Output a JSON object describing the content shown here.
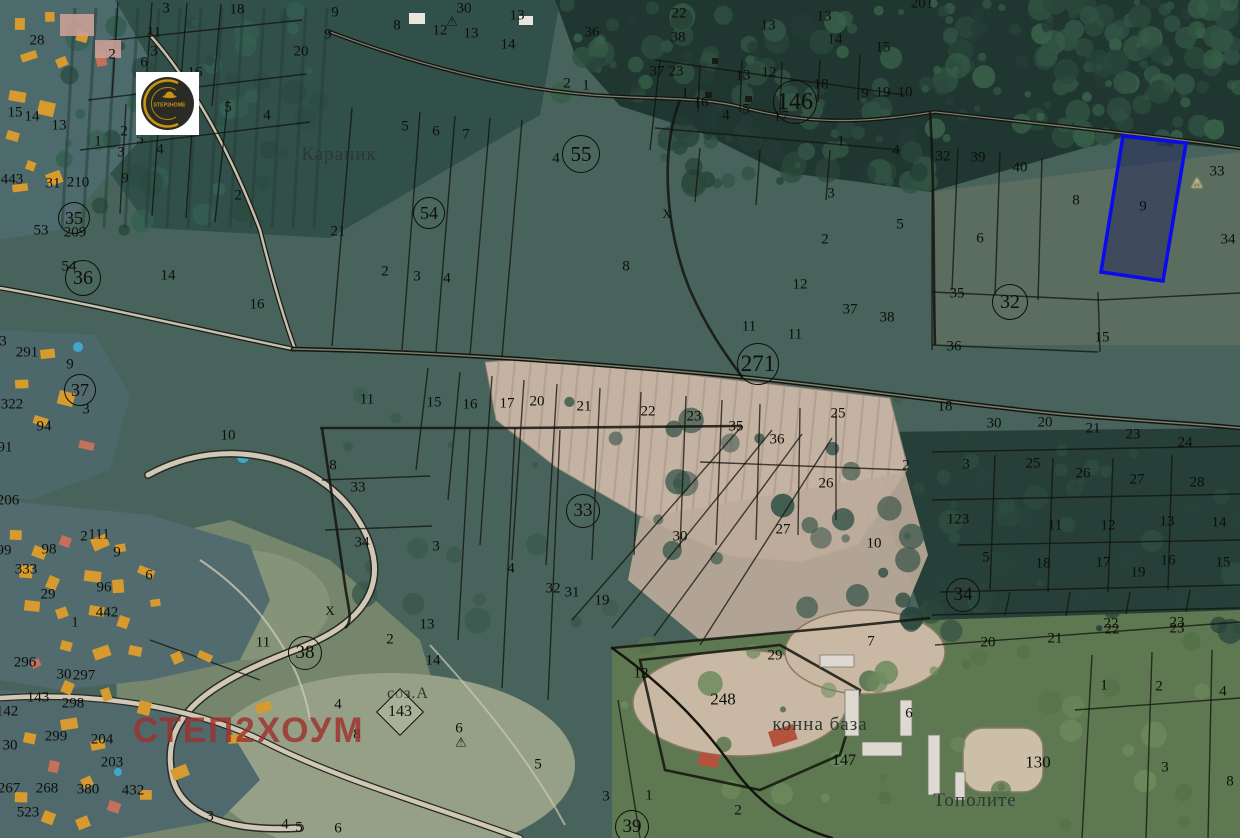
{
  "map": {
    "title": "cadastral-satellite-map",
    "watermark_text": "СТЕП2ХОУМ",
    "logo": {
      "text": "STEP2HOME"
    },
    "colors": {
      "highlight": "#0a0af0",
      "watermark": "#9e312d",
      "logo_gold": "#c8940e"
    },
    "highlighted_parcel": {
      "number": "9",
      "points": "1123,136 1186,143 1163,281 1101,272"
    },
    "place_labels": [
      {
        "t": "Караник",
        "x": 339,
        "y": 155,
        "s": 19
      },
      {
        "t": "соз.А",
        "x": 408,
        "y": 694,
        "s": 16
      },
      {
        "t": "конна база",
        "x": 820,
        "y": 725,
        "s": 19
      },
      {
        "t": "Тополите",
        "x": 975,
        "y": 801,
        "s": 19
      }
    ],
    "zone_markers": [
      {
        "n": "55",
        "x": 581,
        "y": 154,
        "r": 18
      },
      {
        "n": "54",
        "x": 429,
        "y": 213,
        "r": 15
      },
      {
        "n": "146",
        "x": 795,
        "y": 102,
        "r": 21
      },
      {
        "n": "271",
        "x": 758,
        "y": 364,
        "r": 20
      },
      {
        "n": "32",
        "x": 1010,
        "y": 302,
        "r": 17
      },
      {
        "n": "33",
        "x": 583,
        "y": 511,
        "r": 16
      },
      {
        "n": "34",
        "x": 963,
        "y": 595,
        "r": 16
      },
      {
        "n": "35",
        "x": 74,
        "y": 218,
        "r": 15
      },
      {
        "n": "36",
        "x": 83,
        "y": 278,
        "r": 17
      },
      {
        "n": "37",
        "x": 80,
        "y": 390,
        "r": 15
      },
      {
        "n": "38",
        "x": 305,
        "y": 653,
        "r": 16
      },
      {
        "n": "39",
        "x": 632,
        "y": 827,
        "r": 16
      }
    ],
    "diamond_marker": {
      "n": "143",
      "x": 400,
      "y": 712
    },
    "warning_markers": [
      {
        "x": 452,
        "y": 21,
        "variant": "dark"
      },
      {
        "x": 461,
        "y": 742,
        "variant": "dark"
      },
      {
        "x": 1197,
        "y": 183,
        "variant": "gold"
      }
    ],
    "x_marks": [
      {
        "x": 667,
        "y": 214
      },
      {
        "x": 330,
        "y": 611
      }
    ],
    "parcel_labels": [
      {
        "t": "3",
        "x": 166,
        "y": 9
      },
      {
        "t": "18",
        "x": 237,
        "y": 10
      },
      {
        "t": "20",
        "x": 301,
        "y": 52
      },
      {
        "t": "11",
        "x": 154,
        "y": 33
      },
      {
        "t": "3",
        "x": 154,
        "y": 52
      },
      {
        "t": "6",
        "x": 144,
        "y": 63
      },
      {
        "t": "16",
        "x": 195,
        "y": 73
      },
      {
        "t": "2",
        "x": 112,
        "y": 55
      },
      {
        "t": "5",
        "x": 228,
        "y": 108
      },
      {
        "t": "4",
        "x": 267,
        "y": 116
      },
      {
        "t": "28",
        "x": 37,
        "y": 41
      },
      {
        "t": "15",
        "x": 15,
        "y": 113
      },
      {
        "t": "14",
        "x": 32,
        "y": 117
      },
      {
        "t": "13",
        "x": 59,
        "y": 126
      },
      {
        "t": "1",
        "x": 98,
        "y": 142
      },
      {
        "t": "2",
        "x": 124,
        "y": 132
      },
      {
        "t": "5",
        "x": 140,
        "y": 140
      },
      {
        "t": "3",
        "x": 121,
        "y": 153
      },
      {
        "t": "4",
        "x": 160,
        "y": 150
      },
      {
        "t": "9",
        "x": 125,
        "y": 179
      },
      {
        "t": "443",
        "x": 12,
        "y": 180
      },
      {
        "t": "31",
        "x": 53,
        "y": 184
      },
      {
        "t": "210",
        "x": 78,
        "y": 183
      },
      {
        "t": "2",
        "x": 238,
        "y": 196
      },
      {
        "t": "9",
        "x": 335,
        "y": 13
      },
      {
        "t": "9",
        "x": 328,
        "y": 35
      },
      {
        "t": "8",
        "x": 397,
        "y": 26
      },
      {
        "t": "12",
        "x": 440,
        "y": 31
      },
      {
        "t": "13",
        "x": 471,
        "y": 34
      },
      {
        "t": "30",
        "x": 464,
        "y": 9
      },
      {
        "t": "13",
        "x": 517,
        "y": 16
      },
      {
        "t": "14",
        "x": 508,
        "y": 45
      },
      {
        "t": "36",
        "x": 592,
        "y": 33
      },
      {
        "t": "2",
        "x": 567,
        "y": 84
      },
      {
        "t": "1",
        "x": 586,
        "y": 86
      },
      {
        "t": "5",
        "x": 405,
        "y": 127
      },
      {
        "t": "6",
        "x": 436,
        "y": 132
      },
      {
        "t": "7",
        "x": 466,
        "y": 135
      },
      {
        "t": "4",
        "x": 556,
        "y": 159
      },
      {
        "t": "21",
        "x": 338,
        "y": 232
      },
      {
        "t": "2",
        "x": 385,
        "y": 272
      },
      {
        "t": "3",
        "x": 417,
        "y": 277
      },
      {
        "t": "4",
        "x": 447,
        "y": 279
      },
      {
        "t": "22",
        "x": 679,
        "y": 14
      },
      {
        "t": "38",
        "x": 678,
        "y": 38
      },
      {
        "t": "37",
        "x": 657,
        "y": 72
      },
      {
        "t": "23",
        "x": 676,
        "y": 72
      },
      {
        "t": "13",
        "x": 768,
        "y": 26
      },
      {
        "t": "13",
        "x": 824,
        "y": 17
      },
      {
        "t": "14",
        "x": 835,
        "y": 40
      },
      {
        "t": "15",
        "x": 883,
        "y": 48
      },
      {
        "t": "201",
        "x": 922,
        "y": 4
      },
      {
        "t": "12",
        "x": 769,
        "y": 73
      },
      {
        "t": "13",
        "x": 743,
        "y": 76
      },
      {
        "t": "18",
        "x": 821,
        "y": 85
      },
      {
        "t": "9",
        "x": 865,
        "y": 94
      },
      {
        "t": "19",
        "x": 883,
        "y": 93
      },
      {
        "t": "10",
        "x": 905,
        "y": 93
      },
      {
        "t": "1",
        "x": 685,
        "y": 94
      },
      {
        "t": "16",
        "x": 701,
        "y": 103
      },
      {
        "t": "4",
        "x": 726,
        "y": 116
      },
      {
        "t": "5",
        "x": 746,
        "y": 110
      },
      {
        "t": "17",
        "x": 781,
        "y": 117
      },
      {
        "t": "1",
        "x": 841,
        "y": 142
      },
      {
        "t": "4",
        "x": 896,
        "y": 151
      },
      {
        "t": "3",
        "x": 831,
        "y": 194
      },
      {
        "t": "32",
        "x": 943,
        "y": 157
      },
      {
        "t": "39",
        "x": 978,
        "y": 158
      },
      {
        "t": "40",
        "x": 1020,
        "y": 168
      },
      {
        "t": "8",
        "x": 1076,
        "y": 201
      },
      {
        "t": "9",
        "x": 1143,
        "y": 207
      },
      {
        "t": "33",
        "x": 1217,
        "y": 172
      },
      {
        "t": "34",
        "x": 1228,
        "y": 240
      },
      {
        "t": "8",
        "x": 626,
        "y": 267
      },
      {
        "t": "2",
        "x": 825,
        "y": 240
      },
      {
        "t": "5",
        "x": 900,
        "y": 225
      },
      {
        "t": "12",
        "x": 800,
        "y": 285
      },
      {
        "t": "37",
        "x": 850,
        "y": 310
      },
      {
        "t": "38",
        "x": 887,
        "y": 318
      },
      {
        "t": "11",
        "x": 749,
        "y": 327
      },
      {
        "t": "11",
        "x": 795,
        "y": 335
      },
      {
        "t": "6",
        "x": 980,
        "y": 239
      },
      {
        "t": "35",
        "x": 957,
        "y": 294
      },
      {
        "t": "36",
        "x": 954,
        "y": 347
      },
      {
        "t": "15",
        "x": 1102,
        "y": 338
      },
      {
        "t": "18",
        "x": 945,
        "y": 407
      },
      {
        "t": "53",
        "x": 41,
        "y": 231
      },
      {
        "t": "209",
        "x": 75,
        "y": 233
      },
      {
        "t": "54",
        "x": 69,
        "y": 267
      },
      {
        "t": "14",
        "x": 168,
        "y": 276
      },
      {
        "t": "16",
        "x": 257,
        "y": 305
      },
      {
        "t": "291",
        "x": 27,
        "y": 353
      },
      {
        "t": "9",
        "x": 70,
        "y": 365
      },
      {
        "t": "322",
        "x": 12,
        "y": 405
      },
      {
        "t": "3",
        "x": 86,
        "y": 410
      },
      {
        "t": "3",
        "x": 3,
        "y": 342
      },
      {
        "t": "206",
        "x": 8,
        "y": 501
      },
      {
        "t": "10",
        "x": 228,
        "y": 436
      },
      {
        "t": "11",
        "x": 367,
        "y": 400
      },
      {
        "t": "15",
        "x": 434,
        "y": 403
      },
      {
        "t": "16",
        "x": 470,
        "y": 405
      },
      {
        "t": "17",
        "x": 507,
        "y": 404
      },
      {
        "t": "20",
        "x": 537,
        "y": 402
      },
      {
        "t": "21",
        "x": 584,
        "y": 407
      },
      {
        "t": "22",
        "x": 648,
        "y": 412
      },
      {
        "t": "23",
        "x": 694,
        "y": 417
      },
      {
        "t": "35",
        "x": 736,
        "y": 427
      },
      {
        "t": "36",
        "x": 777,
        "y": 440
      },
      {
        "t": "25",
        "x": 838,
        "y": 414
      },
      {
        "t": "26",
        "x": 826,
        "y": 484
      },
      {
        "t": "2",
        "x": 906,
        "y": 466
      },
      {
        "t": "27",
        "x": 783,
        "y": 530
      },
      {
        "t": "30",
        "x": 680,
        "y": 537
      },
      {
        "t": "10",
        "x": 874,
        "y": 544
      },
      {
        "t": "30",
        "x": 994,
        "y": 424
      },
      {
        "t": "20",
        "x": 1045,
        "y": 423
      },
      {
        "t": "21",
        "x": 1093,
        "y": 429
      },
      {
        "t": "23",
        "x": 1133,
        "y": 435
      },
      {
        "t": "24",
        "x": 1185,
        "y": 443
      },
      {
        "t": "3",
        "x": 966,
        "y": 465
      },
      {
        "t": "25",
        "x": 1033,
        "y": 464
      },
      {
        "t": "26",
        "x": 1083,
        "y": 474
      },
      {
        "t": "27",
        "x": 1137,
        "y": 480
      },
      {
        "t": "28",
        "x": 1197,
        "y": 483
      },
      {
        "t": "123",
        "x": 958,
        "y": 520
      },
      {
        "t": "11",
        "x": 1055,
        "y": 526
      },
      {
        "t": "12",
        "x": 1108,
        "y": 526
      },
      {
        "t": "13",
        "x": 1167,
        "y": 522
      },
      {
        "t": "14",
        "x": 1219,
        "y": 523
      },
      {
        "t": "5",
        "x": 986,
        "y": 558
      },
      {
        "t": "18",
        "x": 1043,
        "y": 564
      },
      {
        "t": "17",
        "x": 1103,
        "y": 563
      },
      {
        "t": "16",
        "x": 1168,
        "y": 561
      },
      {
        "t": "15",
        "x": 1223,
        "y": 563
      },
      {
        "t": "19",
        "x": 1138,
        "y": 573
      },
      {
        "t": "22",
        "x": 1111,
        "y": 624
      },
      {
        "t": "23",
        "x": 1177,
        "y": 623
      },
      {
        "t": "94",
        "x": 44,
        "y": 427
      },
      {
        "t": "91",
        "x": 5,
        "y": 448
      },
      {
        "t": "2",
        "x": 84,
        "y": 537
      },
      {
        "t": "111",
        "x": 99,
        "y": 535
      },
      {
        "t": "99",
        "x": 4,
        "y": 551
      },
      {
        "t": "98",
        "x": 49,
        "y": 550
      },
      {
        "t": "9",
        "x": 117,
        "y": 553
      },
      {
        "t": "333",
        "x": 26,
        "y": 570
      },
      {
        "t": "29",
        "x": 48,
        "y": 595
      },
      {
        "t": "96",
        "x": 104,
        "y": 588
      },
      {
        "t": "6",
        "x": 149,
        "y": 576
      },
      {
        "t": "442",
        "x": 107,
        "y": 613
      },
      {
        "t": "1",
        "x": 75,
        "y": 623
      },
      {
        "t": "8",
        "x": 333,
        "y": 466
      },
      {
        "t": "33",
        "x": 358,
        "y": 488
      },
      {
        "t": "34",
        "x": 362,
        "y": 543
      },
      {
        "t": "3",
        "x": 436,
        "y": 547
      },
      {
        "t": "4",
        "x": 511,
        "y": 569
      },
      {
        "t": "32",
        "x": 553,
        "y": 589
      },
      {
        "t": "31",
        "x": 572,
        "y": 593
      },
      {
        "t": "19",
        "x": 602,
        "y": 601
      },
      {
        "t": "13",
        "x": 427,
        "y": 625
      },
      {
        "t": "2",
        "x": 390,
        "y": 640
      },
      {
        "t": "14",
        "x": 433,
        "y": 661
      },
      {
        "t": "11",
        "x": 263,
        "y": 643
      },
      {
        "t": "296",
        "x": 25,
        "y": 663
      },
      {
        "t": "30",
        "x": 64,
        "y": 675
      },
      {
        "t": "297",
        "x": 84,
        "y": 676
      },
      {
        "t": "143",
        "x": 38,
        "y": 698
      },
      {
        "t": "298",
        "x": 73,
        "y": 704
      },
      {
        "t": "142",
        "x": 7,
        "y": 712
      },
      {
        "t": "299",
        "x": 56,
        "y": 737
      },
      {
        "t": "30",
        "x": 10,
        "y": 746
      },
      {
        "t": "204",
        "x": 102,
        "y": 740
      },
      {
        "t": "203",
        "x": 112,
        "y": 763
      },
      {
        "t": "267",
        "x": 9,
        "y": 789
      },
      {
        "t": "268",
        "x": 47,
        "y": 789
      },
      {
        "t": "380",
        "x": 88,
        "y": 790
      },
      {
        "t": "432",
        "x": 133,
        "y": 791
      },
      {
        "t": "523",
        "x": 28,
        "y": 813
      },
      {
        "t": "3",
        "x": 210,
        "y": 817
      },
      {
        "t": "4",
        "x": 285,
        "y": 825
      },
      {
        "t": "5",
        "x": 299,
        "y": 828
      },
      {
        "t": "4",
        "x": 338,
        "y": 705
      },
      {
        "t": "8",
        "x": 357,
        "y": 735
      },
      {
        "t": "6",
        "x": 459,
        "y": 729
      },
      {
        "t": "5",
        "x": 538,
        "y": 765
      },
      {
        "t": "3",
        "x": 606,
        "y": 797
      },
      {
        "t": "6",
        "x": 338,
        "y": 829
      },
      {
        "t": "1",
        "x": 649,
        "y": 796
      },
      {
        "t": "2",
        "x": 738,
        "y": 811
      },
      {
        "t": "12",
        "x": 641,
        "y": 674
      },
      {
        "t": "29",
        "x": 775,
        "y": 656
      },
      {
        "t": "248",
        "x": 723,
        "y": 699,
        "s": 17
      },
      {
        "t": "147",
        "x": 844,
        "y": 761,
        "s": 16
      },
      {
        "t": "7",
        "x": 871,
        "y": 642
      },
      {
        "t": "6",
        "x": 909,
        "y": 714
      },
      {
        "t": "20",
        "x": 988,
        "y": 643
      },
      {
        "t": "21",
        "x": 1055,
        "y": 639
      },
      {
        "t": "22",
        "x": 1112,
        "y": 630
      },
      {
        "t": "23",
        "x": 1177,
        "y": 629
      },
      {
        "t": "1",
        "x": 1104,
        "y": 686
      },
      {
        "t": "2",
        "x": 1159,
        "y": 687
      },
      {
        "t": "4",
        "x": 1223,
        "y": 692
      },
      {
        "t": "130",
        "x": 1038,
        "y": 762,
        "s": 17
      },
      {
        "t": "3",
        "x": 1165,
        "y": 768
      },
      {
        "t": "8",
        "x": 1230,
        "y": 782
      }
    ]
  }
}
